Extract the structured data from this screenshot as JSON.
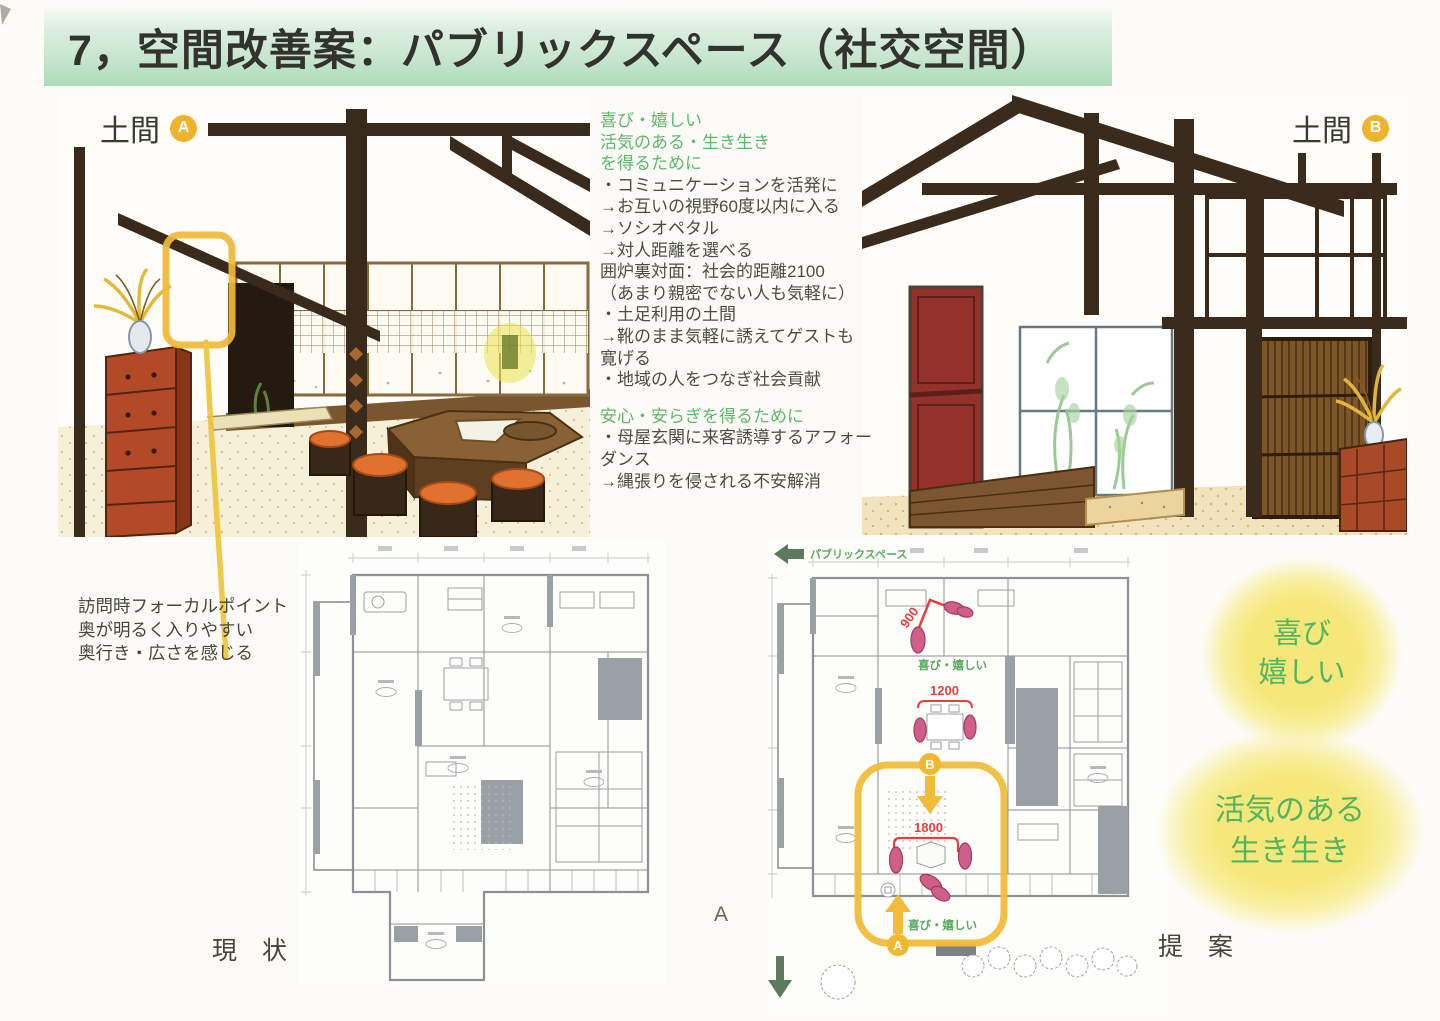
{
  "title": "7，空間改善案：パブリックスペース（社交空間）",
  "palette": {
    "banner_green": "#bfe3c7",
    "heading_green": "#5cb86a",
    "body_text": "#4a4a44",
    "marker_yellow": "#f2b72e",
    "highlight_yellow": "#f0b83a",
    "dimension_red": "#e2413e",
    "people_pink": "#cf5f8a",
    "blob_yellow": "#f6e77a",
    "plan_gray": "#8b9196"
  },
  "sketch_a": {
    "label": "土間",
    "marker": "A"
  },
  "sketch_b": {
    "label": "土間",
    "marker": "B"
  },
  "notes": {
    "lines": [
      {
        "text": "喜び・嬉しい",
        "style": "green"
      },
      {
        "text": "活気のある・生き生き",
        "style": "green"
      },
      {
        "text": "を得るために",
        "style": "green"
      },
      {
        "text": "・コミュニケーションを活発に",
        "style": ""
      },
      {
        "text": "→お互いの視野60度以内に入る",
        "style": ""
      },
      {
        "text": "→ソシオペタル",
        "style": ""
      },
      {
        "text": "→対人距離を選べる",
        "style": ""
      },
      {
        "text": "囲炉裏対面：社会的距離2100",
        "style": ""
      },
      {
        "text": "（あまり親密でない人も気軽に）",
        "style": ""
      },
      {
        "text": "・土足利用の土間",
        "style": ""
      },
      {
        "text": "→靴のまま気軽に誘えてゲストも",
        "style": ""
      },
      {
        "text": "寛げる",
        "style": ""
      },
      {
        "text": "・地域の人をつなぎ社会貢献",
        "style": ""
      },
      {
        "text": "",
        "style": "spacer"
      },
      {
        "text": "安心・安らぎを得るために",
        "style": "green"
      },
      {
        "text": "・母屋玄関に来客誘導するアフォー",
        "style": ""
      },
      {
        "text": "ダンス",
        "style": ""
      },
      {
        "text": "→縄張りを侵される不安解消",
        "style": ""
      }
    ]
  },
  "focal_note": {
    "lines": [
      "訪問時フォーカルポイント",
      "奥が明るく入りやすい",
      "奥行き・広さを感じる"
    ]
  },
  "plan_current": {
    "caption": "現　状"
  },
  "plan_proposal": {
    "caption": "提　案",
    "space_label": "パブリックスペース",
    "joy_center": "喜び・嬉しい",
    "joy_bottom": "喜び・嬉しい",
    "dim_900": "900",
    "dim_1200": "1200",
    "dim_1800": "1800",
    "marker_a": "A",
    "marker_b": "B"
  },
  "floor_letter": "A",
  "blobs": [
    {
      "line1": "喜び",
      "line2": "嬉しい"
    },
    {
      "line1": "活気のある",
      "line2": "生き生き"
    }
  ]
}
